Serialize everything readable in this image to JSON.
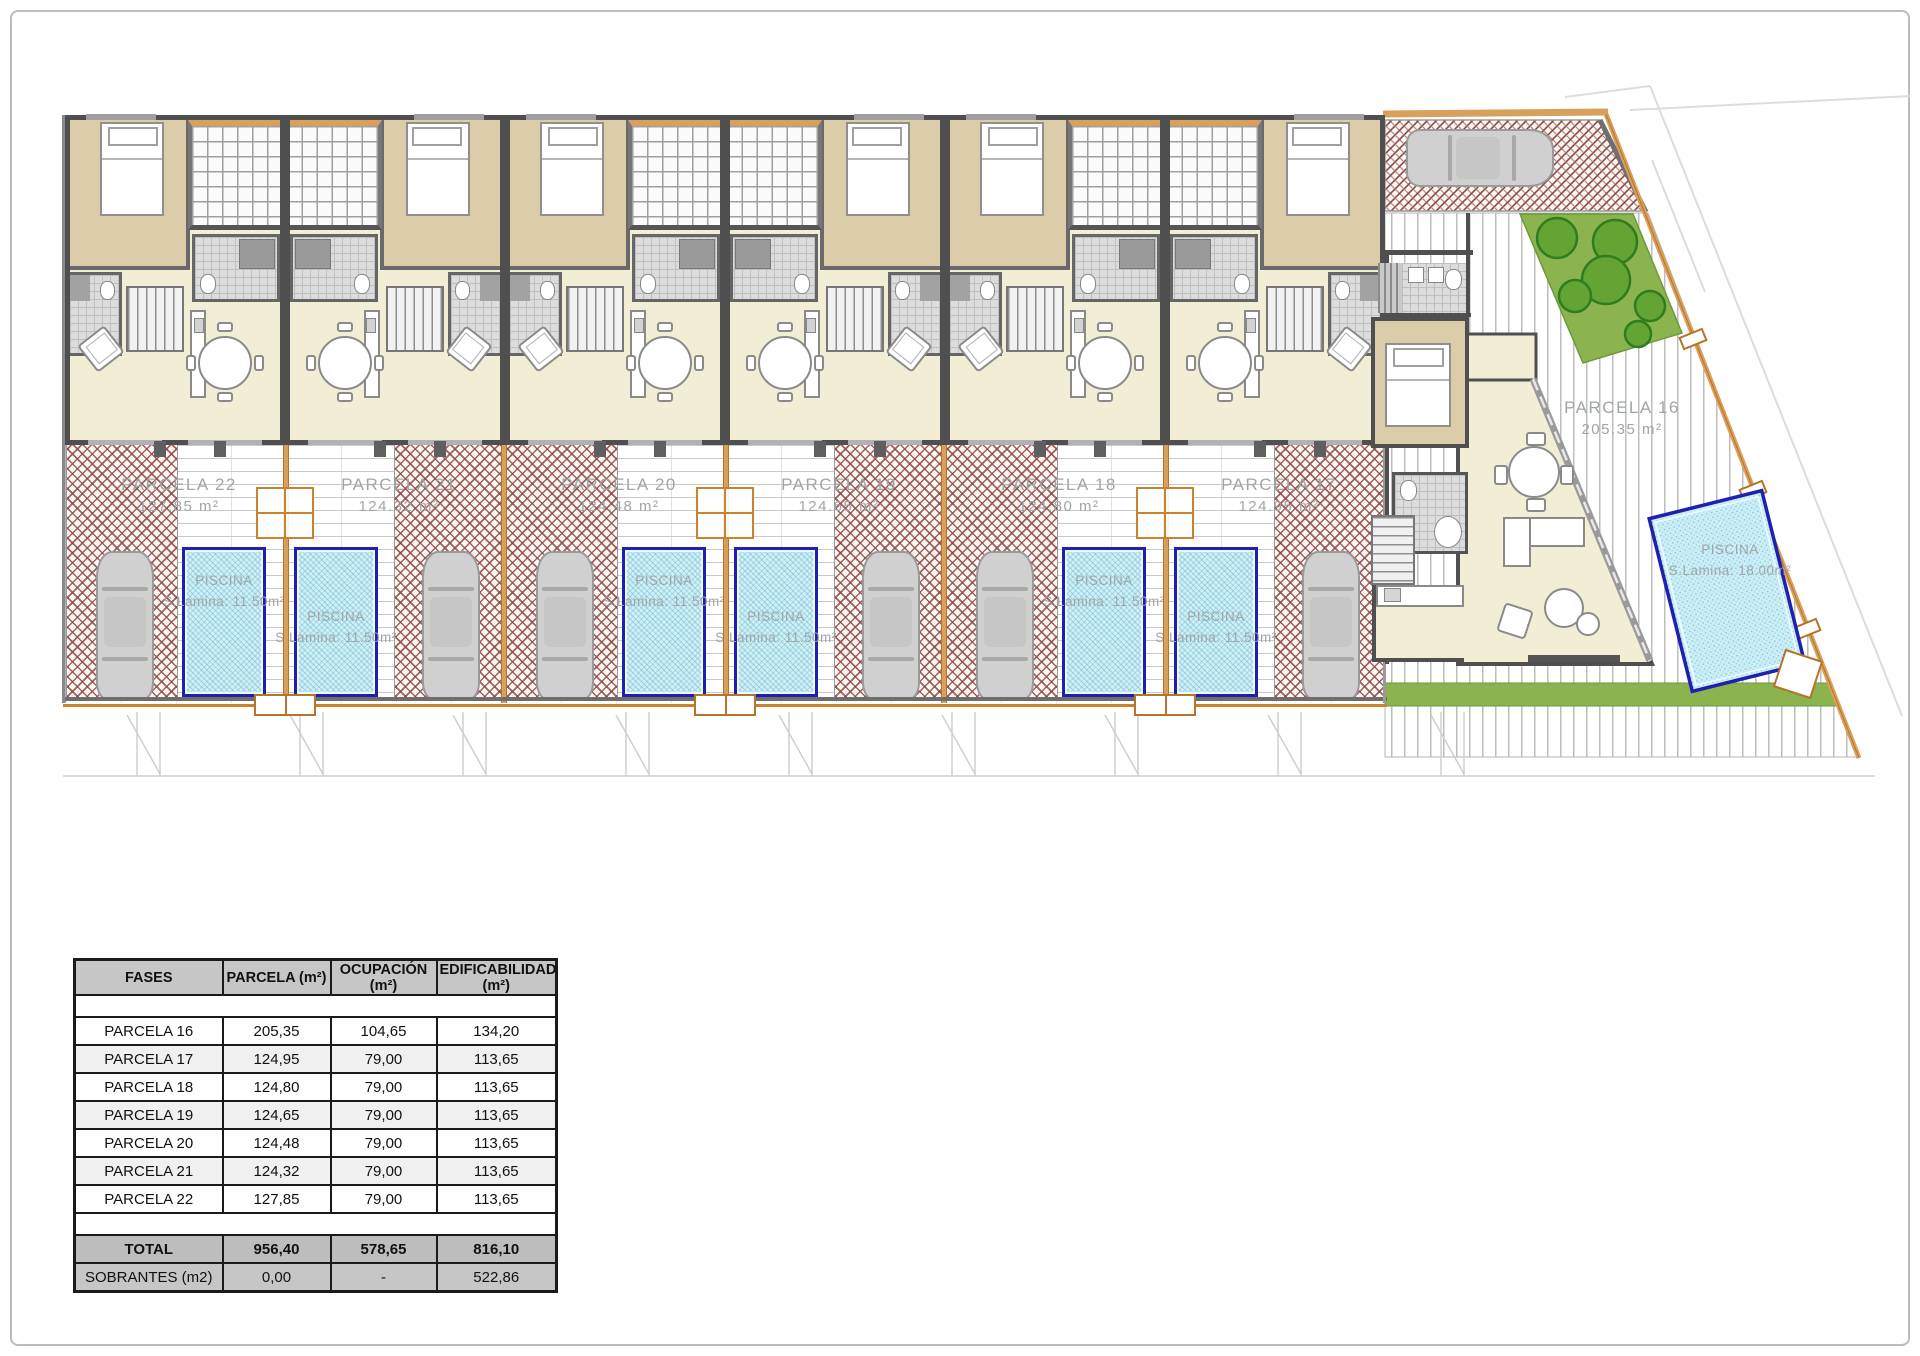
{
  "plan": {
    "parcels": [
      {
        "name": "PARCELA 22",
        "area": "127.85 m²"
      },
      {
        "name": "PARCELA 21",
        "area": "124.32 m²"
      },
      {
        "name": "PARCELA 20",
        "area": "124.48 m²"
      },
      {
        "name": "PARCELA 19",
        "area": "124.65 m²"
      },
      {
        "name": "PARCELA 18",
        "area": "124.80 m²"
      },
      {
        "name": "PARCELA 17",
        "area": "124.95 m²"
      },
      {
        "name": "PARCELA 16",
        "area": "205.35 m²"
      }
    ],
    "pool_small": {
      "line1": "PISCINA",
      "line2": "S.Lamina: 11.50m²"
    },
    "pool_large": {
      "line1": "PISCINA",
      "line2": "S.Lamina: 18.00m²"
    },
    "colors": {
      "floor": "#f2eed6",
      "bedroom": "#dbcda9",
      "wall": "#4f4f4f",
      "pool_fill": "#cfeef6",
      "pool_border": "#2020b0",
      "paving_red": "#8d4a42",
      "garden_green": "#8cb44e",
      "tree_green": "#2e7d1e",
      "boundary_tan": "#d9a05b",
      "gate_orange": "#c8832c",
      "label_gray": "#a0a6a6"
    }
  },
  "table": {
    "headers": [
      "FASES",
      "PARCELA (m²)",
      "OCUPACIÓN (m²)",
      "EDIFICABILIDAD (m²)"
    ],
    "rows": [
      {
        "fase": "PARCELA 16",
        "parcela": "205,35",
        "ocupacion": "104,65",
        "edificabilidad": "134,20"
      },
      {
        "fase": "PARCELA 17",
        "parcela": "124,95",
        "ocupacion": "79,00",
        "edificabilidad": "113,65"
      },
      {
        "fase": "PARCELA 18",
        "parcela": "124,80",
        "ocupacion": "79,00",
        "edificabilidad": "113,65"
      },
      {
        "fase": "PARCELA 19",
        "parcela": "124,65",
        "ocupacion": "79,00",
        "edificabilidad": "113,65"
      },
      {
        "fase": "PARCELA 20",
        "parcela": "124,48",
        "ocupacion": "79,00",
        "edificabilidad": "113,65"
      },
      {
        "fase": "PARCELA 21",
        "parcela": "124,32",
        "ocupacion": "79,00",
        "edificabilidad": "113,65"
      },
      {
        "fase": "PARCELA 22",
        "parcela": "127,85",
        "ocupacion": "79,00",
        "edificabilidad": "113,65"
      }
    ],
    "total": {
      "fase": "TOTAL",
      "parcela": "956,40",
      "ocupacion": "578,65",
      "edificabilidad": "816,10"
    },
    "sobrantes": {
      "fase": "SOBRANTES (m2)",
      "parcela": "0,00",
      "ocupacion": "-",
      "edificabilidad": "522,86"
    }
  }
}
